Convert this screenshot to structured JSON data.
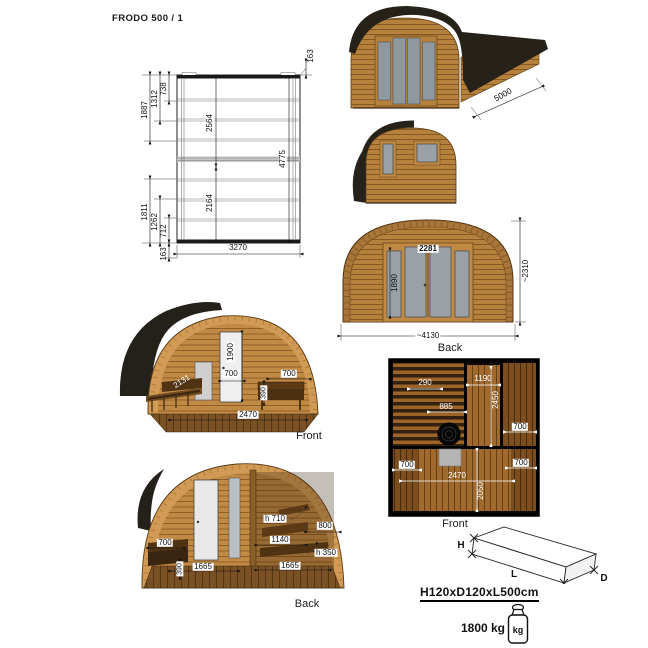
{
  "title": "FRODO  500 / 1",
  "floor_plan": {
    "d1887": "1887",
    "d1312": "1312",
    "d738": "738",
    "d163_top": "163",
    "d2564": "2564",
    "d4775": "4775",
    "d2164": "2164",
    "d1811": "1811",
    "d1262": "1262",
    "d712": "712",
    "d163_bottom": "163",
    "d3270": "3270"
  },
  "perspective": {
    "d5000": "5000"
  },
  "elevation": {
    "d2281": "2281",
    "d1890": "1890",
    "d2310": "~2310",
    "d4130": "~4130",
    "caption": "Back"
  },
  "cutaway_front": {
    "d1900": "1900",
    "d700_door": "700",
    "d2131": "2131",
    "d390": "390",
    "d700_bench": "700",
    "d2470": "2470",
    "caption": "Front"
  },
  "cutaway_back": {
    "d700": "700",
    "d390": "390",
    "d1665_left": "1665",
    "d1665_right": "1665",
    "dh710": "h 710",
    "d800": "800",
    "d1140": "1140",
    "dh350": "h 350",
    "caption": "Back"
  },
  "interior_plan": {
    "d290": "290",
    "d1190": "1190",
    "d2450": "2450",
    "d885": "885",
    "d700_top_right": "700",
    "d700_bottom_left": "700",
    "d700_bottom_right": "700",
    "d2470": "2470",
    "d2050": "2050",
    "caption": "Front"
  },
  "package": {
    "h": "H",
    "l": "L",
    "d": "D",
    "size": "H120xD120xL500cm",
    "weight": "1800 kg",
    "unit": "kg"
  }
}
